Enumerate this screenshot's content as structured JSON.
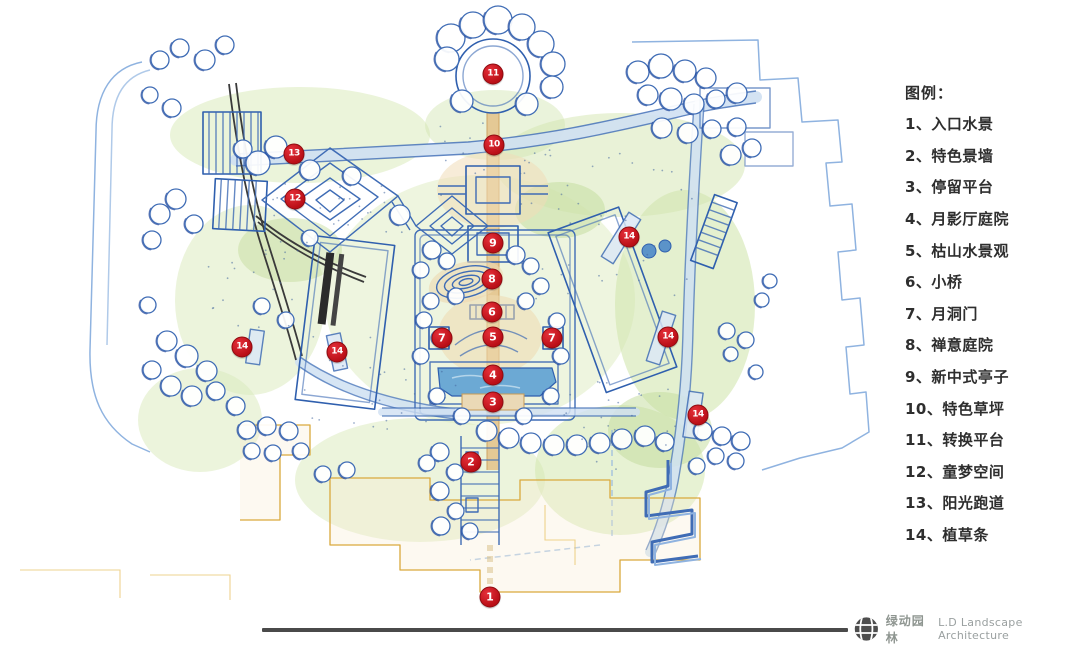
{
  "legend": {
    "title": "图例：",
    "items": [
      {
        "label": "1、入口水景"
      },
      {
        "label": "2、特色景墙"
      },
      {
        "label": "3、停留平台"
      },
      {
        "label": "4、月影厅庭院"
      },
      {
        "label": "5、枯山水景观"
      },
      {
        "label": "6、小桥"
      },
      {
        "label": "7、月洞门"
      },
      {
        "label": "8、禅意庭院"
      },
      {
        "label": "9、新中式亭子"
      },
      {
        "label": "10、特色草坪"
      },
      {
        "label": "11、转换平台"
      },
      {
        "label": "12、童梦空间"
      },
      {
        "label": "13、阳光跑道"
      },
      {
        "label": "14、植草条"
      }
    ]
  },
  "markers": [
    {
      "label": "1",
      "x": 490,
      "y": 597
    },
    {
      "label": "2",
      "x": 471,
      "y": 462
    },
    {
      "label": "3",
      "x": 493,
      "y": 402
    },
    {
      "label": "4",
      "x": 493,
      "y": 375
    },
    {
      "label": "5",
      "x": 493,
      "y": 337
    },
    {
      "label": "6",
      "x": 492,
      "y": 312
    },
    {
      "label": "7",
      "x": 442,
      "y": 338
    },
    {
      "label": "7",
      "x": 552,
      "y": 338
    },
    {
      "label": "8",
      "x": 492,
      "y": 279
    },
    {
      "label": "9",
      "x": 493,
      "y": 243
    },
    {
      "label": "10",
      "x": 494,
      "y": 145
    },
    {
      "label": "11",
      "x": 493,
      "y": 74
    },
    {
      "label": "12",
      "x": 295,
      "y": 199
    },
    {
      "label": "13",
      "x": 294,
      "y": 154
    },
    {
      "label": "14",
      "x": 242,
      "y": 347
    },
    {
      "label": "14",
      "x": 337,
      "y": 352
    },
    {
      "label": "14",
      "x": 629,
      "y": 237
    },
    {
      "label": "14",
      "x": 668,
      "y": 337
    },
    {
      "label": "14",
      "x": 698,
      "y": 415
    }
  ],
  "footer": {
    "brand_cn": "绿动园林",
    "brand_en": "L.D Landscape Architecture"
  },
  "colors": {
    "marker_red": "#c1121c",
    "legend_text": "#2e2e2e",
    "footer_gray": "#9aa0a0",
    "divider_dark": "#4a4a4a",
    "ink_blue": "#3f6cb5",
    "lawn_green": "#cde3a6",
    "path_tan": "#e3c48d",
    "water_blue": "#6ca9d4"
  }
}
